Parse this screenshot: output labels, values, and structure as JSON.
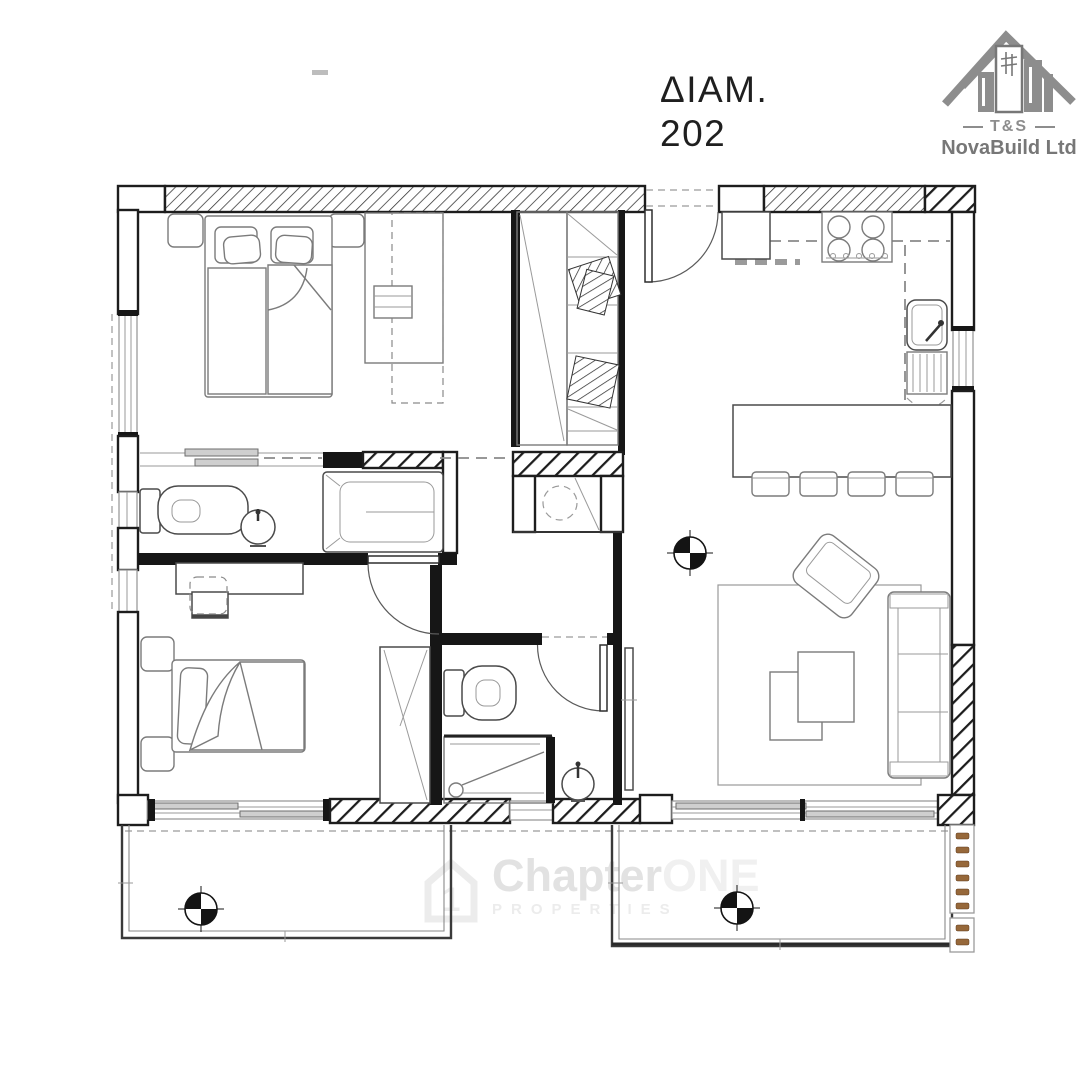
{
  "title": {
    "line1": "ΔΙΑΜ.",
    "line2": "202"
  },
  "logo": {
    "abbr": "T&S",
    "name": "NovaBuild Ltd"
  },
  "watermark": {
    "icon_digit": "1",
    "brand_main": "Chapter",
    "brand_accent": "ONE",
    "tagline": "PROPERTIES"
  },
  "colors": {
    "wall": "#1d1d1d",
    "furniture_line": "#7b7b7b",
    "window_line": "#9b9b9b",
    "balcony_louver_brown": "#96683a",
    "logo_gray": "#8d8d8d",
    "watermark_gray": "#e7e7e7",
    "title_text": "#1f1f1f"
  }
}
